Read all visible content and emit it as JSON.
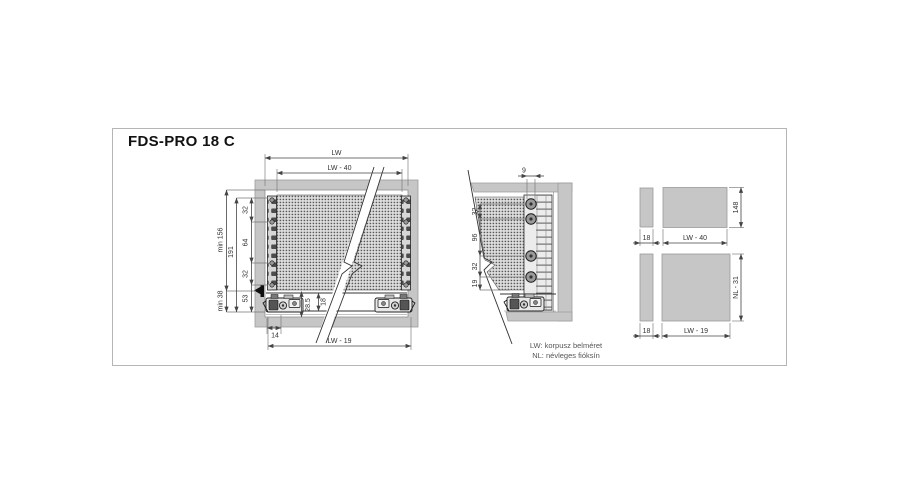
{
  "title": "FDS-PRO 18 C",
  "legend": {
    "lw": "LW: korpusz belméret",
    "nl": "NL: névleges fióksín"
  },
  "front_view": {
    "dim_lw": "LW",
    "dim_lw40": "LW - 40",
    "dim_lw19": "LW - 19",
    "dim_min156": "min 156",
    "dim_191": "191",
    "dim_32_top": "32",
    "dim_64": "64",
    "dim_32_bottom": "32",
    "dim_min38": "min 38",
    "dim_53": "53",
    "dim_28_5": "28.5",
    "dim_18": "18",
    "dim_14": "14"
  },
  "side_view": {
    "dim_9": "9",
    "dim_32_top": "32",
    "dim_96": "96",
    "dim_32_bottom": "32",
    "dim_19": "19"
  },
  "section_top": {
    "dim_18": "18",
    "dim_width": "LW - 40",
    "dim_height": "148"
  },
  "section_bottom": {
    "dim_18": "18",
    "dim_width": "LW - 19",
    "dim_height": "NL - 31"
  },
  "colors": {
    "panel_gray": "#c6c6c6",
    "line": "#444444",
    "dim_text": "#333333"
  }
}
